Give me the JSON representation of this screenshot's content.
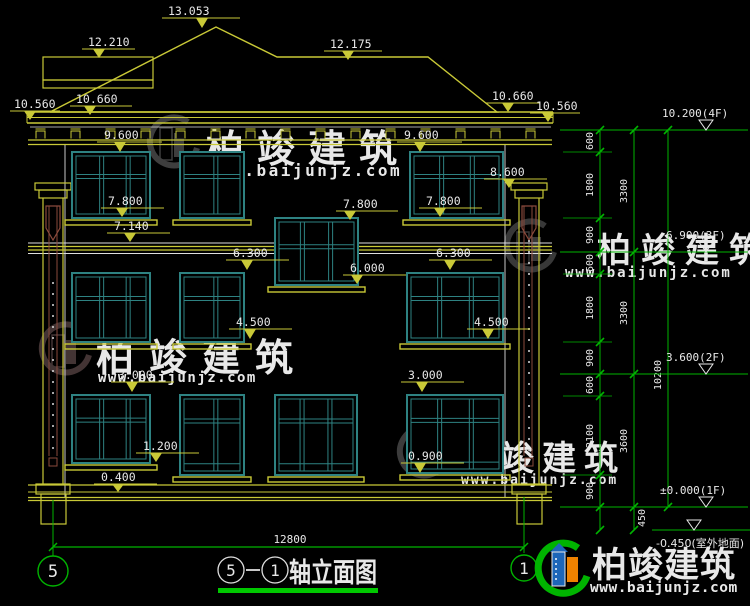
{
  "drawing": {
    "facade_markers": {
      "peak": "13.053",
      "ridge_left": "12.210",
      "ridge_right": "12.175",
      "eave_far_left": "10.560",
      "eave_left": "10.660",
      "eave_right": "10.660",
      "eave_far_right": "10.560",
      "cornice_left": "9.600",
      "cornice_right": "9.600",
      "pilaster_top": "8.600",
      "sill3f_left": "7.800",
      "stair_win_top": "7.800",
      "sill3f_right": "7.800",
      "band3f": "7.140",
      "head2f_left": "6.300",
      "head2f_right": "6.300",
      "stair_win_sill": "6.000",
      "sill2f_left": "4.500",
      "sill2f_right": "4.500",
      "head1f_left": "3.000",
      "head1f_right": "3.000",
      "sill1f_left": "1.200",
      "sill1f_center": "0.900",
      "base_band": "0.400"
    },
    "right_levels": [
      {
        "label": "10.200(4F)"
      },
      {
        "label": "6.900(3F)"
      },
      {
        "label": "3.600(2F)"
      },
      {
        "label": "±0.000(1F)"
      },
      {
        "label": "-0.450(室外地面)"
      }
    ],
    "dim_chain": {
      "col1": [
        "600",
        "1800",
        "900",
        "600",
        "1800",
        "900",
        "600",
        "2100",
        "900"
      ],
      "col1_extra": "450",
      "col2": [
        "3300",
        "3300",
        "3600"
      ],
      "overall": "10200"
    },
    "bottom_dim": "12800",
    "axis_bubbles": {
      "left": "5",
      "right": "1"
    },
    "title": {
      "axis_start": "5",
      "separator": "—",
      "axis_end": "1",
      "name": "轴立面图"
    }
  },
  "watermark": {
    "company": "柏竣建筑",
    "url": "www.baijunjz.com"
  },
  "footer_logo": {
    "company": "柏竣建筑",
    "url": "www.baijunjz.com"
  }
}
